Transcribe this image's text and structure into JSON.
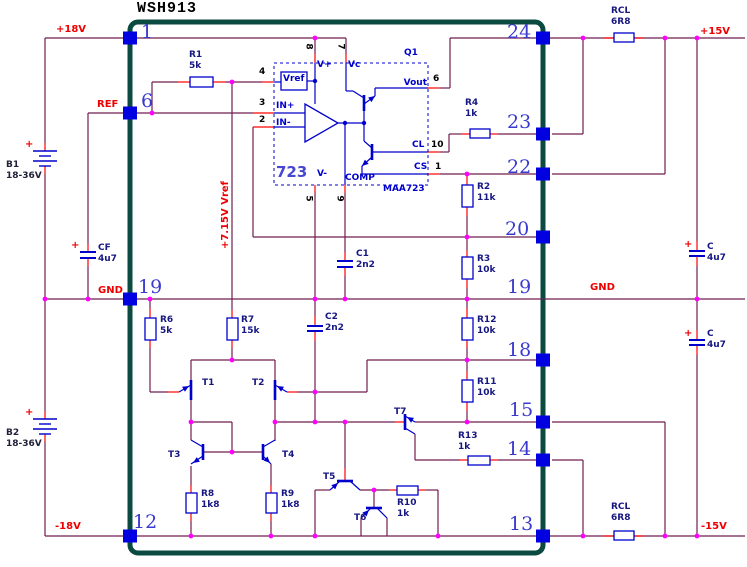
{
  "title": "WSH913",
  "colors": {
    "wire": "#721d50",
    "lead": "#ff0000",
    "component": "#0000cc",
    "junction": "#ff00ff",
    "junction_ic": "#0000cc",
    "border": "#0a4a40",
    "pin_bump": "#0000e0",
    "label_red": "#ee0000",
    "label_navy": "#171782",
    "pin_number": "#3a3ace"
  },
  "labels": {
    "rail_p18": "+18V",
    "rail_ref": "REF",
    "rail_gnd_l": "GND",
    "rail_m18": "-18V",
    "rail_p15": "+15V",
    "rail_gnd_r": "GND",
    "rail_m15": "-15V",
    "vref_rail": "+7.15V Vref",
    "plus": "+"
  },
  "module": {
    "pins": {
      "p1": "1",
      "p6": "6",
      "p19l": "19",
      "p12": "12",
      "p24": "24",
      "p23": "23",
      "p22": "22",
      "p20": "20",
      "p19r": "19",
      "p18": "18",
      "p15": "15",
      "p14": "14",
      "p13": "13"
    }
  },
  "ic": {
    "q": "Q1",
    "part": "MAA723",
    "family": "723",
    "labels": {
      "vref": "Vref",
      "vplus": "V+",
      "vc": "Vc",
      "vout": "Vout",
      "cl": "CL",
      "cs": "CS",
      "vminus": "V-",
      "comp": "COMP",
      "inp": "IN+",
      "inn": "IN-"
    },
    "pins": {
      "n4": "4",
      "n3": "3",
      "n2": "2",
      "n8": "8",
      "n7": "7",
      "n6": "6",
      "n10": "10",
      "n1": "1",
      "n5": "5",
      "n9": "9"
    }
  },
  "components": {
    "r1": {
      "ref": "R1",
      "val": "5k"
    },
    "r2": {
      "ref": "R2",
      "val": "11k"
    },
    "r3": {
      "ref": "R3",
      "val": "10k"
    },
    "r4": {
      "ref": "R4",
      "val": "1k"
    },
    "r6": {
      "ref": "R6",
      "val": "5k"
    },
    "r7": {
      "ref": "R7",
      "val": "15k"
    },
    "r8": {
      "ref": "R8",
      "val": "1k8"
    },
    "r9": {
      "ref": "R9",
      "val": "1k8"
    },
    "r10": {
      "ref": "R10",
      "val": "1k"
    },
    "r11": {
      "ref": "R11",
      "val": "10k"
    },
    "r12": {
      "ref": "R12",
      "val": "10k"
    },
    "r13": {
      "ref": "R13",
      "val": "1k"
    },
    "rcl_top": {
      "ref": "RCL",
      "val": "6R8"
    },
    "rcl_bottom": {
      "ref": "RCL",
      "val": "6R8"
    },
    "c1": {
      "ref": "C1",
      "val": "2n2"
    },
    "c2": {
      "ref": "C2",
      "val": "2n2"
    },
    "cf": {
      "ref": "CF",
      "val": "4u7"
    },
    "c_top": {
      "ref": "C",
      "val": "4u7"
    },
    "c_bottom": {
      "ref": "C",
      "val": "4u7"
    },
    "b1": {
      "ref": "B1",
      "val": "18-36V"
    },
    "b2": {
      "ref": "B2",
      "val": "18-36V"
    },
    "t1": {
      "ref": "T1"
    },
    "t2": {
      "ref": "T2"
    },
    "t3": {
      "ref": "T3"
    },
    "t4": {
      "ref": "T4"
    },
    "t5": {
      "ref": "T5"
    },
    "t6": {
      "ref": "T6"
    },
    "t7": {
      "ref": "T7"
    }
  }
}
